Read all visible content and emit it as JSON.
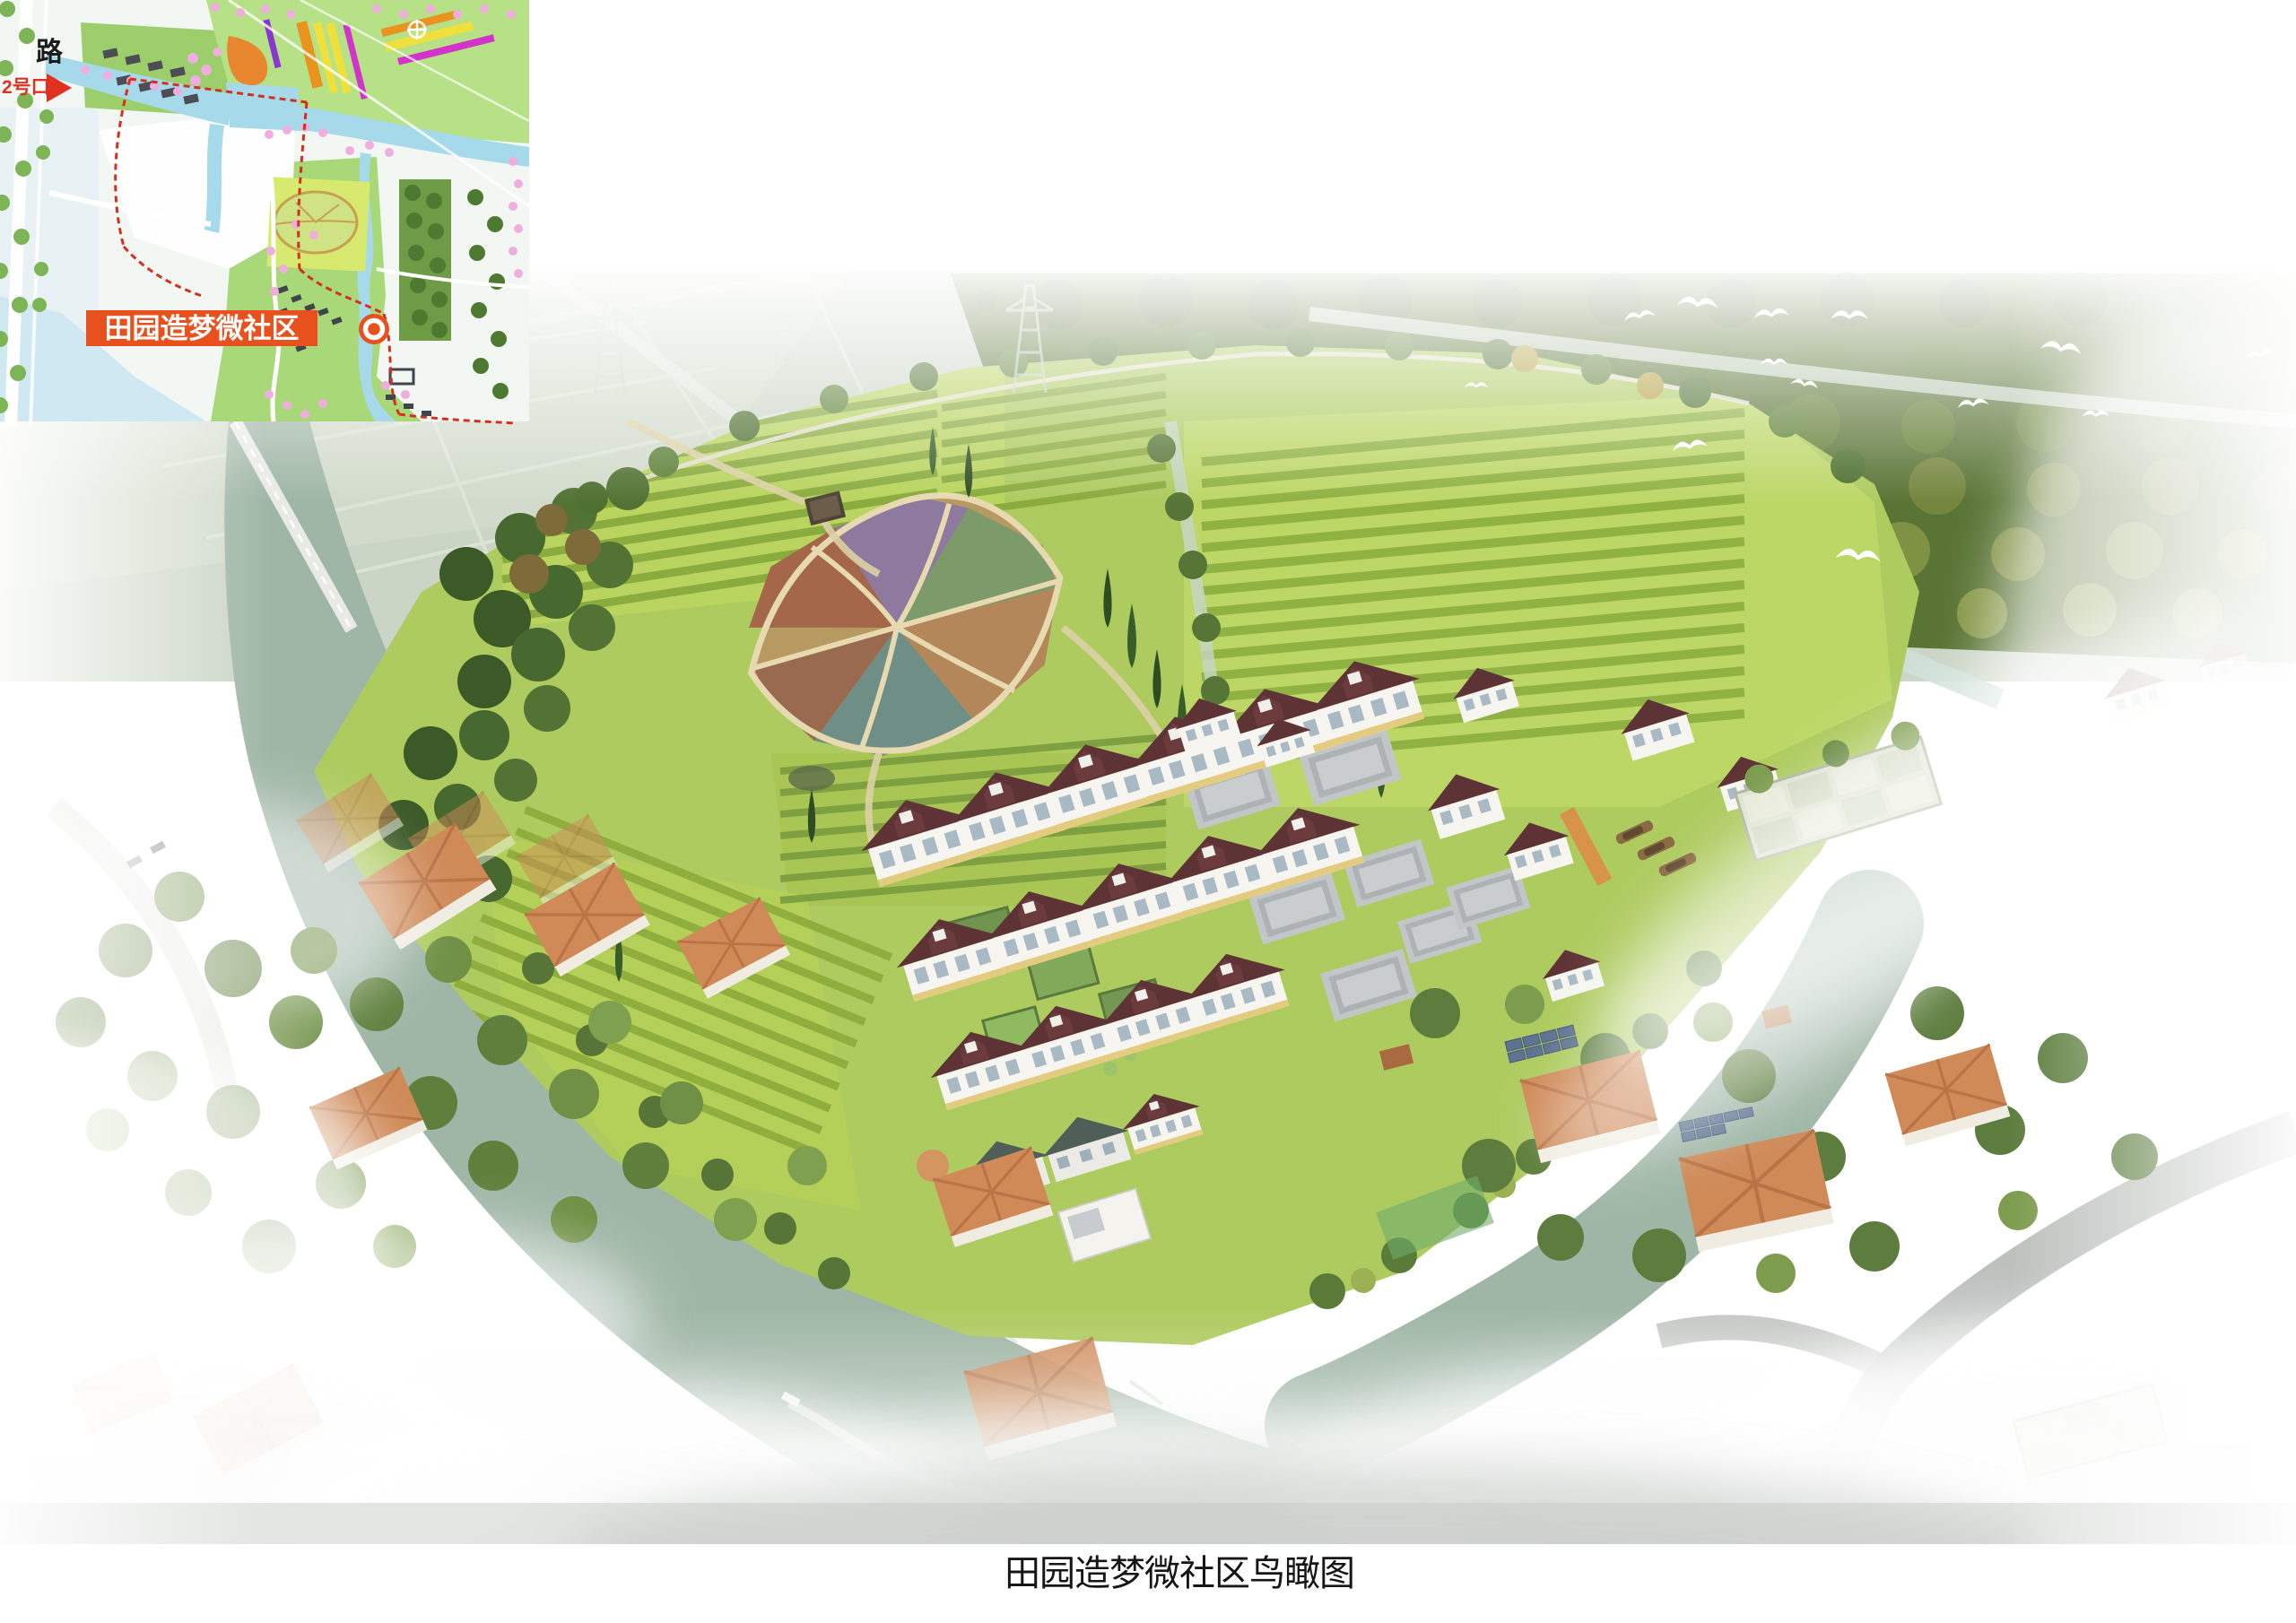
{
  "document": {
    "background_color": "#ffffff",
    "caption": "田园造梦微社区鸟瞰图"
  },
  "inset_map": {
    "road_label": "路",
    "entrance_label": "2号口",
    "site_label": "田园造梦微社区",
    "label_background": "#e8511d",
    "marker_color": "#e8511d",
    "boundary_dash_color": "#d43020",
    "water_color": "#a6d9ea",
    "field_color": "#b7e187",
    "blossom_color": "#efaede",
    "crop_strip_colors": [
      "#f0e03c",
      "#e8941f",
      "#d233c9",
      "#8838d0"
    ]
  },
  "rendering": {
    "type": "aerial-birdseye-render",
    "site_name": "田园造梦微社区",
    "palette": {
      "river": "#9fb6a6",
      "farmland_light": "#c3dc64",
      "farmland_dark": "#8aab3e",
      "forest": "#55702f",
      "new_village_roof": "#5e3336",
      "new_village_wall": "#f6f5f0",
      "existing_village_roof": "#cf8a58",
      "fog": "#ffffff"
    }
  }
}
